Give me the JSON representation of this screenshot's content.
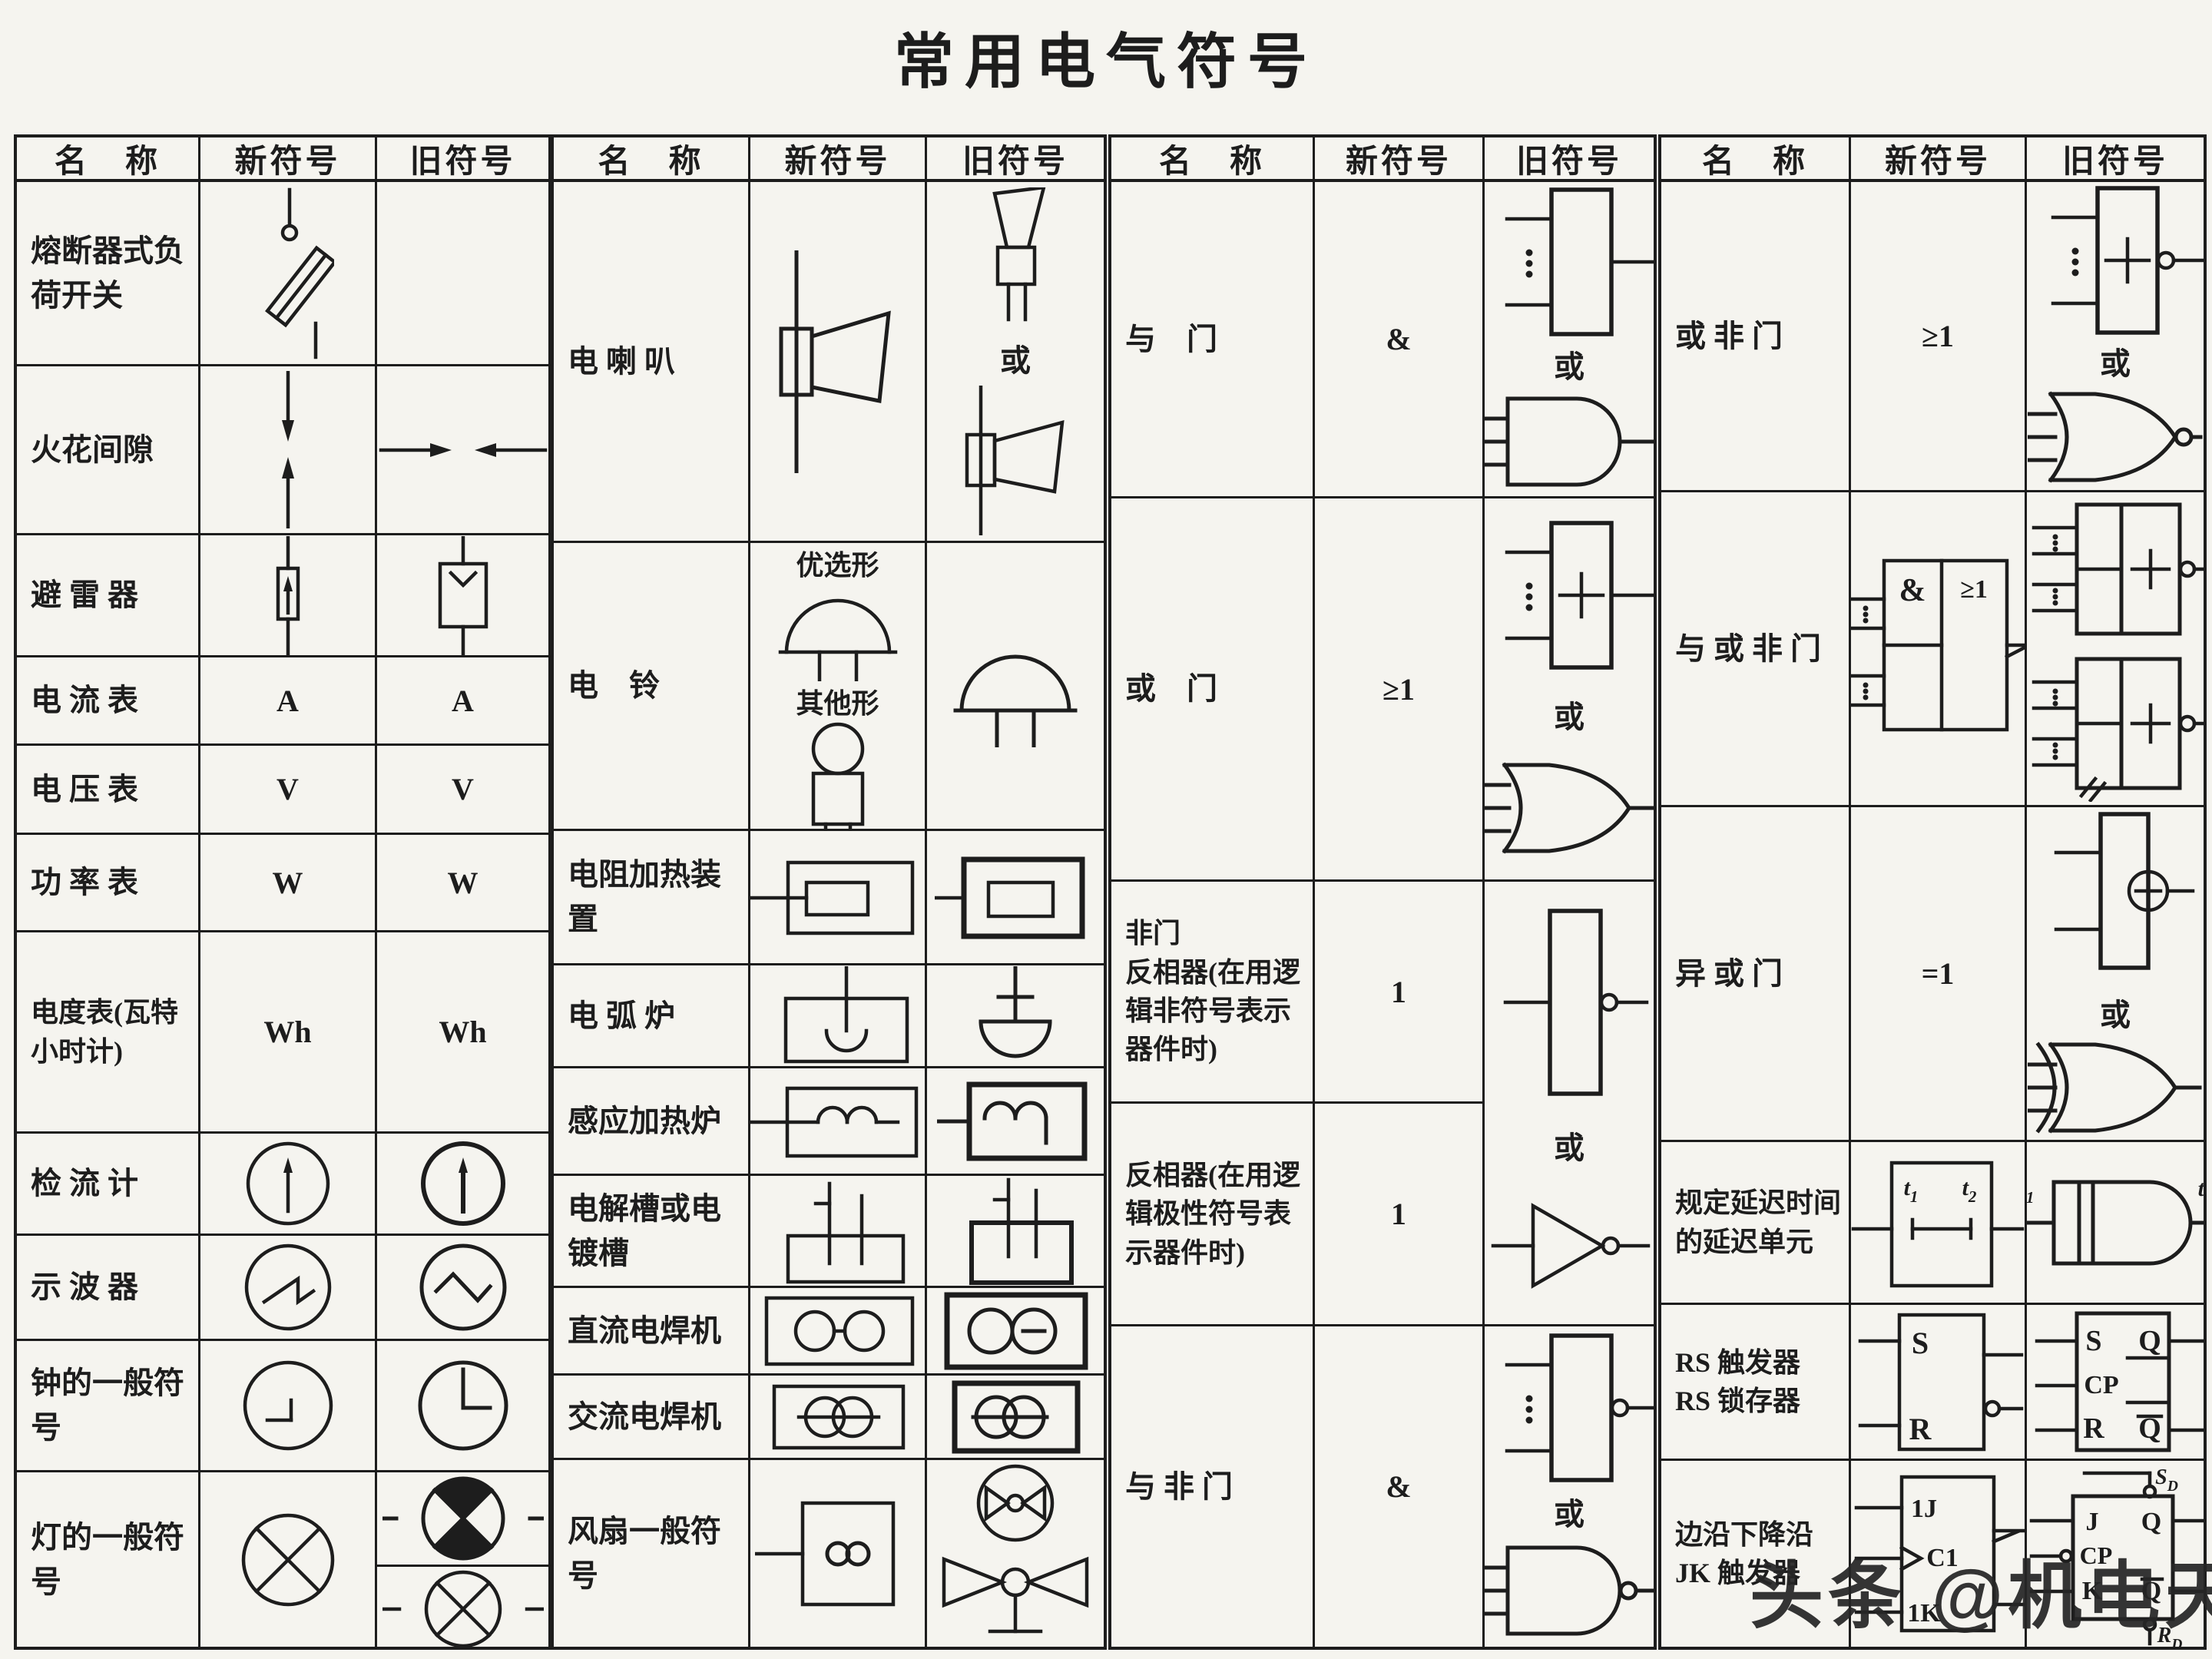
{
  "title": "常用电气符号",
  "watermark": "头条 @机电天下",
  "colors": {
    "ink": "#1d1d1d",
    "paper": "#f5f4ef"
  },
  "header": {
    "name": "名　称",
    "new": "新符号",
    "old": "旧符号"
  },
  "or_label": "或",
  "groups": [
    {
      "rows": [
        {
          "name": "熔断器式负荷开关",
          "new": [
            {
              "sym": "fuse-switch"
            }
          ],
          "old": []
        },
        {
          "name": "火花间隙",
          "new": [
            {
              "sym": "spark-gap-v"
            }
          ],
          "old": [
            {
              "sym": "spark-gap-h"
            }
          ]
        },
        {
          "name": "避 雷 器",
          "new": [
            {
              "sym": "arrester-new"
            }
          ],
          "old": [
            {
              "sym": "arrester-old"
            }
          ]
        },
        {
          "name": "电 流 表",
          "new": [
            {
              "sym": "meter",
              "text": "A"
            }
          ],
          "old": [
            {
              "sym": "meter",
              "text": "A",
              "bold": true
            }
          ]
        },
        {
          "name": "电 压 表",
          "new": [
            {
              "sym": "meter",
              "text": "V"
            }
          ],
          "old": [
            {
              "sym": "meter",
              "text": "V",
              "bold": true
            }
          ]
        },
        {
          "name": "功 率 表",
          "new": [
            {
              "sym": "meter",
              "text": "W"
            }
          ],
          "old": [
            {
              "sym": "meter",
              "text": "W",
              "bold": true
            }
          ]
        },
        {
          "name": "电度表(瓦特小时计)",
          "new": [
            {
              "sym": "wh-meter",
              "text": "Wh"
            }
          ],
          "old": [
            {
              "sym": "wh-meter",
              "text": "Wh",
              "bold": true
            }
          ]
        },
        {
          "name": "检 流 计",
          "new": [
            {
              "sym": "galvanometer"
            }
          ],
          "old": [
            {
              "sym": "galvanometer",
              "bold": true
            }
          ]
        },
        {
          "name": "示 波 器",
          "new": [
            {
              "sym": "scope-saw"
            }
          ],
          "old": [
            {
              "sym": "scope-tri"
            }
          ]
        },
        {
          "name": "钟的一般符号",
          "new": [
            {
              "sym": "clock-new"
            }
          ],
          "old": [
            {
              "sym": "clock-old"
            }
          ]
        },
        {
          "name": "灯的一般符号",
          "new": [
            {
              "sym": "lamp-x"
            }
          ],
          "old": [
            {
              "sym": "lamp-ind"
            },
            {
              "divider": true
            },
            {
              "sym": "lamp-x-leads"
            }
          ]
        }
      ]
    },
    {
      "rows": [
        {
          "name": "电 喇 叭",
          "new": [
            {
              "sym": "horn-right"
            }
          ],
          "old": [
            {
              "sym": "horn-up"
            },
            {
              "text": "或"
            },
            {
              "sym": "horn-right",
              "small": true
            }
          ]
        },
        {
          "name": "电　铃",
          "new": [
            {
              "label": "优选形"
            },
            {
              "sym": "bell-dome",
              "small": true
            },
            {
              "label": "其他形"
            },
            {
              "sym": "bell-figure"
            }
          ],
          "old": [
            {
              "sym": "bell-dome"
            }
          ]
        },
        {
          "name": "电阻加热装置",
          "new": [
            {
              "sym": "heater-new"
            }
          ],
          "old": [
            {
              "sym": "heater-old"
            }
          ]
        },
        {
          "name": "电 弧 炉",
          "new": [
            {
              "sym": "arc-furnace-new"
            }
          ],
          "old": [
            {
              "sym": "arc-furnace-old"
            }
          ]
        },
        {
          "name": "感应加热炉",
          "new": [
            {
              "sym": "induction-new"
            }
          ],
          "old": [
            {
              "sym": "induction-old"
            }
          ]
        },
        {
          "name": "电解槽或电镀槽",
          "new": [
            {
              "sym": "electrolyzer-new"
            }
          ],
          "old": [
            {
              "sym": "electrolyzer-old"
            }
          ]
        },
        {
          "name": "直流电焊机",
          "new": [
            {
              "sym": "dc-welder-new"
            }
          ],
          "old": [
            {
              "sym": "dc-welder-old"
            }
          ]
        },
        {
          "name": "交流电焊机",
          "new": [
            {
              "sym": "ac-welder-new"
            }
          ],
          "old": [
            {
              "sym": "ac-welder-old"
            }
          ]
        },
        {
          "name": "风扇一般符号",
          "new": [
            {
              "sym": "fan-new"
            }
          ],
          "old": [
            {
              "sym": "fan-circle"
            },
            {
              "sym": "fan-prop"
            }
          ]
        }
      ]
    },
    {
      "rows": [
        {
          "name": "与　门",
          "new": [
            {
              "sym": "gate",
              "text": "&"
            }
          ],
          "old": [
            {
              "sym": "old-box"
            },
            {
              "text": "或"
            },
            {
              "sym": "and-shape"
            }
          ]
        },
        {
          "name": "或　门",
          "new": [
            {
              "sym": "gate",
              "text": "≥1"
            }
          ],
          "old": [
            {
              "sym": "old-box",
              "plus": true
            },
            {
              "text": "或"
            },
            {
              "sym": "or-shape"
            }
          ]
        },
        {
          "name": "非门\n反相器(在用逻辑非符号表示器件时)",
          "new": [
            {
              "sym": "gate",
              "text": "1",
              "bubble": true
            }
          ],
          "oldSpan": 2,
          "old": [
            {
              "sym": "not-old-box"
            },
            {
              "text": "或"
            },
            {
              "sym": "inv-triangle"
            }
          ]
        },
        {
          "name": "反相器(在用逻辑极性符号表示器件时)",
          "new": [
            {
              "sym": "gate",
              "text": "1",
              "wedge": true
            }
          ],
          "old": null
        },
        {
          "name": "与 非 门",
          "new": [
            {
              "sym": "gate",
              "text": "&",
              "bubble": true
            }
          ],
          "old": [
            {
              "sym": "old-box",
              "bubble": true
            },
            {
              "text": "或"
            },
            {
              "sym": "and-shape",
              "bubble": true
            }
          ]
        }
      ]
    },
    {
      "rows": [
        {
          "name": "或 非 门",
          "new": [
            {
              "sym": "gate",
              "text": "≥1",
              "bubble": true
            }
          ],
          "old": [
            {
              "sym": "old-box",
              "plus": true,
              "bubble": true
            },
            {
              "text": "或"
            },
            {
              "sym": "or-shape",
              "bubble": true
            }
          ]
        },
        {
          "name": "与 或 非 门",
          "new": [
            {
              "sym": "aon-new",
              "texts": [
                "&",
                "≥1"
              ]
            }
          ],
          "old": [
            {
              "sym": "aon-old",
              "texts": [
                "+"
              ]
            },
            {
              "sym": "aon-old",
              "texts": [
                "+"
              ],
              "hatch": true
            }
          ]
        },
        {
          "name": "异 或 门",
          "new": [
            {
              "sym": "gate",
              "text": "=1"
            }
          ],
          "old": [
            {
              "sym": "xor-old-box"
            },
            {
              "text": "或"
            },
            {
              "sym": "or-shape",
              "xor": true
            }
          ]
        },
        {
          "name": "规定延迟时间的延迟单元",
          "new": [
            {
              "sym": "delay-new",
              "texts": [
                "t",
                "1",
                "t",
                "2"
              ]
            }
          ],
          "old": [
            {
              "sym": "delay-old",
              "texts": [
                "t",
                "1",
                "t",
                "2"
              ]
            }
          ]
        },
        {
          "name": "RS 触发器\nRS 锁存器",
          "new": [
            {
              "sym": "rs-new",
              "texts": [
                "S",
                "R"
              ]
            }
          ],
          "old": [
            {
              "sym": "rs-old",
              "texts": [
                "S",
                "Q",
                "CP",
                "R",
                "Q"
              ]
            }
          ]
        },
        {
          "name": "边沿下降沿\nJK 触发器",
          "new": [
            {
              "sym": "jk-new",
              "texts": [
                "1J",
                "C1",
                "1K"
              ]
            }
          ],
          "old": [
            {
              "sym": "jk-old",
              "texts": [
                "S",
                "D",
                "J",
                "Q",
                "CP",
                "K",
                "Q",
                "R",
                "D"
              ]
            }
          ]
        }
      ]
    }
  ]
}
